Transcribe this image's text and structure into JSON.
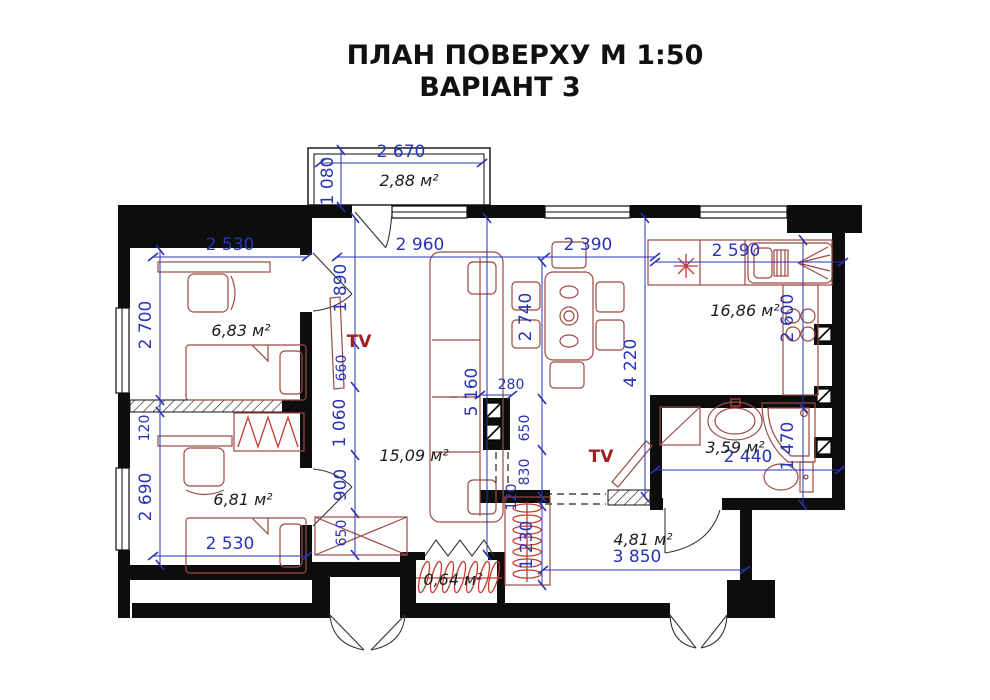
{
  "title": {
    "line1": "ПЛАН ПОВЕРХУ   М 1:50",
    "line2": "ВАРІАНТ 3"
  },
  "rooms": {
    "balcony": {
      "area": "2,88 м²",
      "width": "2 670",
      "depth": "1 080"
    },
    "bedroom_top": {
      "area": "6,83 м²",
      "width": "2 530",
      "height": "2 700"
    },
    "bedroom_bottom": {
      "area": "6,81 м²",
      "width": "2 530",
      "height": "2 690"
    },
    "living": {
      "area": "15,09 м²",
      "width": "2 960",
      "height": "5 160"
    },
    "kitchen": {
      "area": "16,86 м²",
      "width": "2 590",
      "height": "2 600"
    },
    "bathroom": {
      "area": "3,59 м²",
      "width": "2 440",
      "height": "1 470"
    },
    "hall": {
      "area": "4,81 м²",
      "width": "3 850"
    },
    "closet": {
      "area": "0,64 м²"
    }
  },
  "chain_dims": {
    "living_left": [
      "1 890",
      "660",
      "1 060",
      "900",
      "650"
    ],
    "center_right": [
      "280",
      "650",
      "830",
      "120",
      "1 230"
    ],
    "partition": "120",
    "dining_width": "2 390",
    "dining_height": "2 740",
    "dining_total": "4 220"
  },
  "labels": {
    "tv_living": "TV",
    "tv_hall": "TV"
  },
  "colors": {
    "dimension_blue": "#2833b5",
    "furniture_brown": "#9b4a42",
    "hanger_red": "#c23b32",
    "tv_red": "#a11f1f",
    "wall_black": "#0d0d0d"
  }
}
